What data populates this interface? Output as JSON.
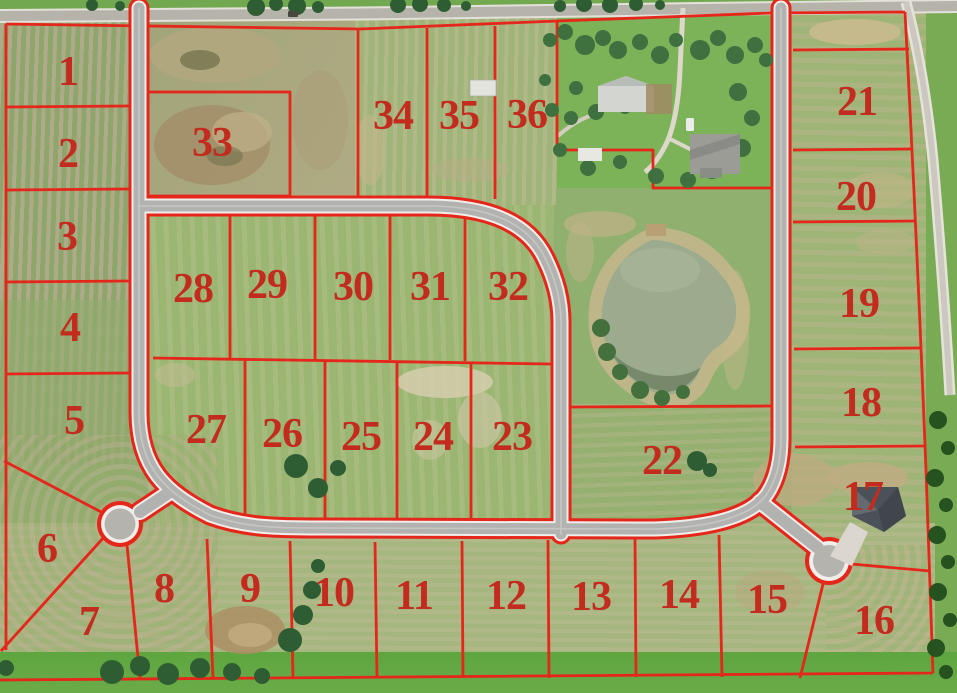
{
  "map": {
    "colors": {
      "boundary_line": "#e5261a",
      "lot_label": "#c32b1e",
      "road_gray": "#b2b2b0",
      "field_green": "#93ae71",
      "pond_water": "#9cab8e",
      "grass_bright": "#5ea63f"
    },
    "lots": [
      {
        "label": "1",
        "x": 68,
        "y": 72
      },
      {
        "label": "2",
        "x": 68,
        "y": 154
      },
      {
        "label": "3",
        "x": 67,
        "y": 237
      },
      {
        "label": "4",
        "x": 70,
        "y": 328
      },
      {
        "label": "5",
        "x": 74,
        "y": 421
      },
      {
        "label": "6",
        "x": 47,
        "y": 549
      },
      {
        "label": "7",
        "x": 89,
        "y": 622
      },
      {
        "label": "8",
        "x": 164,
        "y": 589
      },
      {
        "label": "9",
        "x": 250,
        "y": 589
      },
      {
        "label": "10",
        "x": 334,
        "y": 593
      },
      {
        "label": "11",
        "x": 414,
        "y": 596
      },
      {
        "label": "12",
        "x": 506,
        "y": 596
      },
      {
        "label": "13",
        "x": 591,
        "y": 597
      },
      {
        "label": "14",
        "x": 679,
        "y": 595
      },
      {
        "label": "15",
        "x": 767,
        "y": 600
      },
      {
        "label": "16",
        "x": 874,
        "y": 621
      },
      {
        "label": "17",
        "x": 863,
        "y": 497
      },
      {
        "label": "18",
        "x": 861,
        "y": 403
      },
      {
        "label": "19",
        "x": 859,
        "y": 304
      },
      {
        "label": "20",
        "x": 856,
        "y": 197
      },
      {
        "label": "21",
        "x": 857,
        "y": 102
      },
      {
        "label": "22",
        "x": 662,
        "y": 461
      },
      {
        "label": "23",
        "x": 512,
        "y": 437
      },
      {
        "label": "24",
        "x": 433,
        "y": 437
      },
      {
        "label": "25",
        "x": 361,
        "y": 437
      },
      {
        "label": "26",
        "x": 282,
        "y": 434
      },
      {
        "label": "27",
        "x": 206,
        "y": 430
      },
      {
        "label": "28",
        "x": 193,
        "y": 289
      },
      {
        "label": "29",
        "x": 267,
        "y": 285
      },
      {
        "label": "30",
        "x": 353,
        "y": 287
      },
      {
        "label": "31",
        "x": 430,
        "y": 287
      },
      {
        "label": "32",
        "x": 508,
        "y": 287
      },
      {
        "label": "33",
        "x": 212,
        "y": 143
      },
      {
        "label": "34",
        "x": 393,
        "y": 116
      },
      {
        "label": "35",
        "x": 459,
        "y": 116
      },
      {
        "label": "36",
        "x": 527,
        "y": 115
      }
    ]
  }
}
